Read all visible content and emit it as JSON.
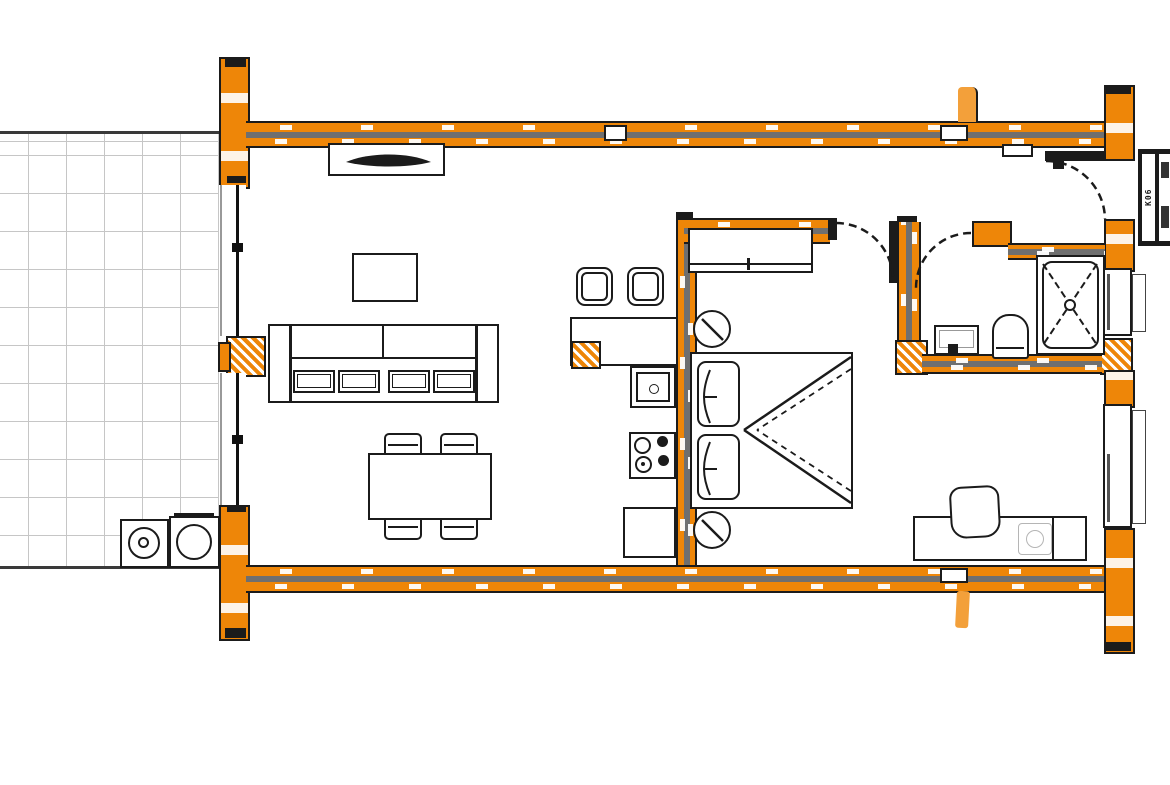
{
  "document": {
    "title": "Floor Plan"
  },
  "colors": {
    "wall": "#EE8608",
    "wall_light": "#F3A03A",
    "outline": "#1B1B1B",
    "wall_core": "#6F6F6F",
    "grid_line": "#C6C6C6",
    "faint_gray": "#B5B5B5"
  },
  "cabinet": {
    "label": "K06"
  },
  "rooms": [
    "terrace",
    "living-room",
    "kitchen",
    "hallway",
    "bedroom",
    "bathroom"
  ],
  "fixtures": [
    "tv-sideboard",
    "sofa",
    "coffee-table",
    "dining-table",
    "dining-chair",
    "bar-stool",
    "kitchen-counter",
    "kitchen-sink",
    "stove",
    "base-cabinet",
    "wardrobe",
    "double-bed",
    "bedside-lamp",
    "desk",
    "desk-chair",
    "shower",
    "toilet",
    "washbasin",
    "washing-machine",
    "tumble-dryer"
  ]
}
